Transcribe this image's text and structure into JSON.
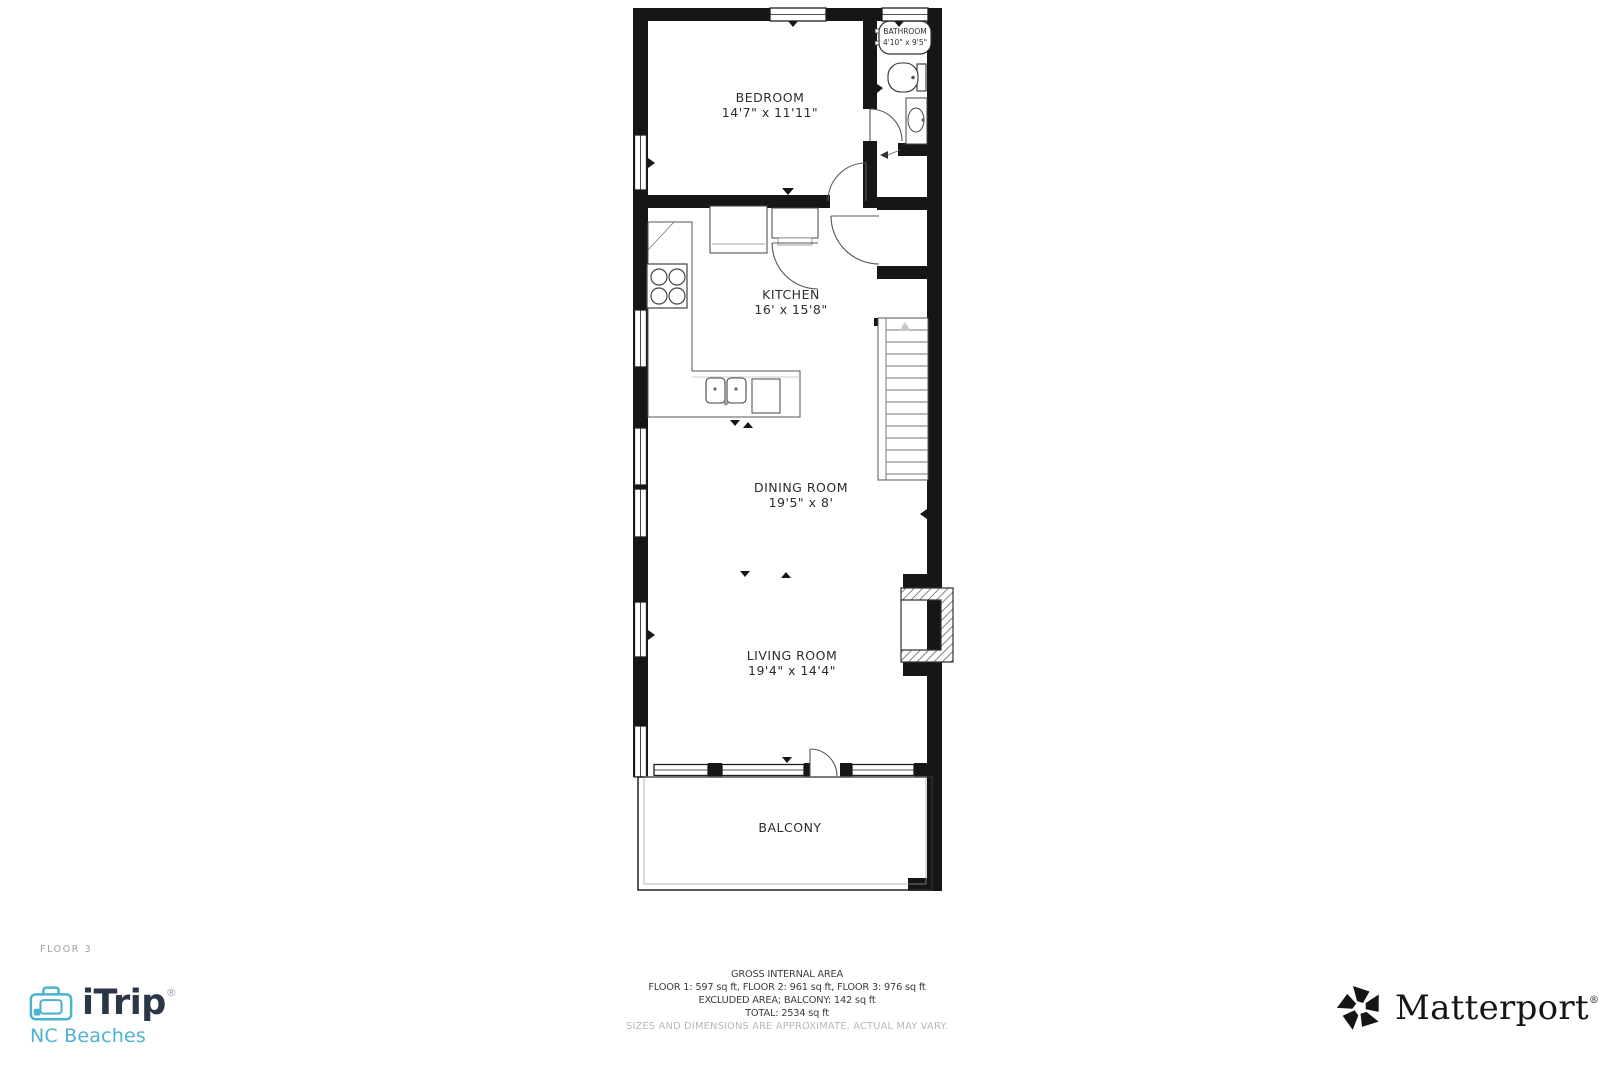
{
  "floor_label": "FLOOR 3",
  "rooms": {
    "bedroom": {
      "name": "BEDROOM",
      "dims": "14'7\" x 11'11\""
    },
    "bathroom": {
      "name": "BATHROOM",
      "dims": "4'10\" x 9'5\""
    },
    "kitchen": {
      "name": "KITCHEN",
      "dims": "16' x 15'8\""
    },
    "dining_room": {
      "name": "DINING ROOM",
      "dims": "19'5\" x 8'"
    },
    "living_room": {
      "name": "LIVING ROOM",
      "dims": "19'4\" x 14'4\""
    },
    "balcony": {
      "name": "BALCONY"
    }
  },
  "area_summary": {
    "title": "GROSS INTERNAL AREA",
    "line1": "FLOOR 1: 597 sq ft, FLOOR 2: 961 sq ft, FLOOR 3: 976 sq ft",
    "line2": "EXCLUDED AREA; BALCONY: 142 sq ft",
    "line3": "TOTAL: 2534 sq ft",
    "disclaimer": "SIZES AND DIMENSIONS ARE APPROXIMATE, ACTUAL MAY VARY."
  },
  "branding": {
    "itrip": {
      "name": "iTrip",
      "registered": "®",
      "region": "NC Beaches",
      "accent": "#4ab3cd",
      "navy": "#2b3747"
    },
    "matterport": {
      "name": "Matterport",
      "registered": "®",
      "color": "#151515"
    }
  }
}
